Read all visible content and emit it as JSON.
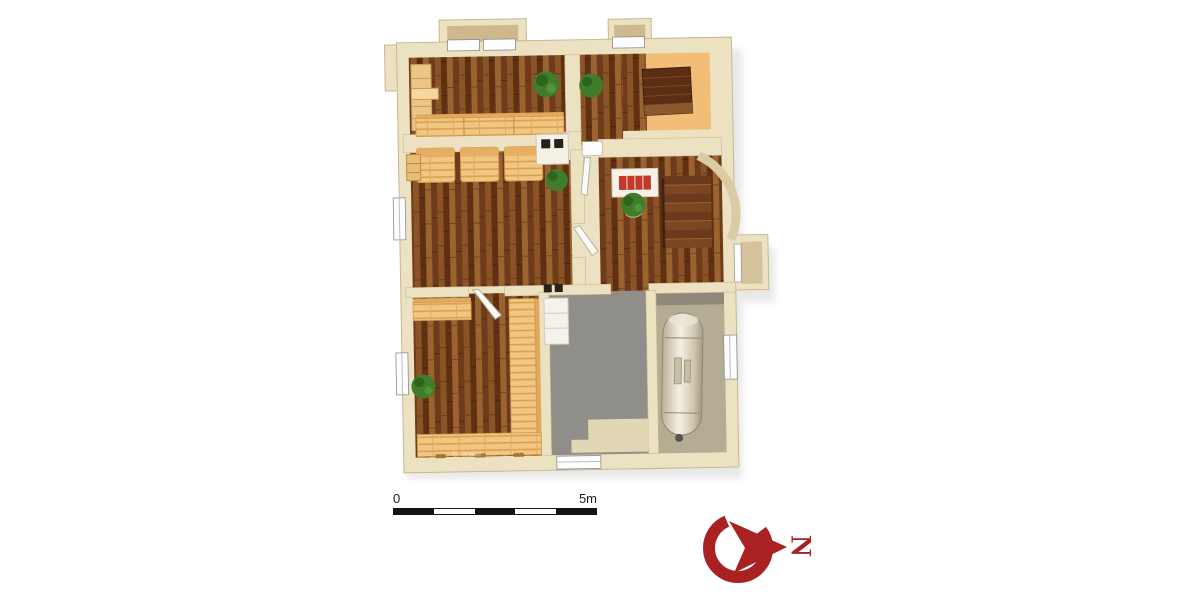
{
  "scene": {
    "kind": "3d-floorplan-top-down-render",
    "background": "#ffffff"
  },
  "floorplan": {
    "objects": [
      "wardrobe-shelf",
      "wall-bench",
      "potted-plants",
      "wood-loungers",
      "sauna-benches-u-shape",
      "stove-unit",
      "fireplace-red-insert",
      "staircase-with-railing",
      "arched-wall-opening",
      "boiler-tank",
      "white-cabinet",
      "windows",
      "door-leaves",
      "entry-door"
    ]
  },
  "scale_bar": {
    "start_label": "0",
    "end_label": "5m",
    "segments": 5,
    "dark_color": "#141414",
    "light_color": "#ffffff"
  },
  "compass": {
    "label": "N",
    "rotation_deg": 90,
    "color": "#a92121"
  },
  "watermark": {
    "text": "© www.··········"
  },
  "colors": {
    "page_bg": "#ffffff",
    "wall": "#ece2c2",
    "wall_shade": "#cdb98d",
    "floor_dark_wood": "#7a451f",
    "floor_light_wood": "#f2c680",
    "floor_orange": "#f2bd76",
    "floor_gray": "#8f8e88",
    "boiler_floor": "#b4ac93",
    "plant_green": "#3f7d2b",
    "fire_red": "#c23b2a",
    "compass_red": "#a92121",
    "scale_black": "#141414"
  }
}
